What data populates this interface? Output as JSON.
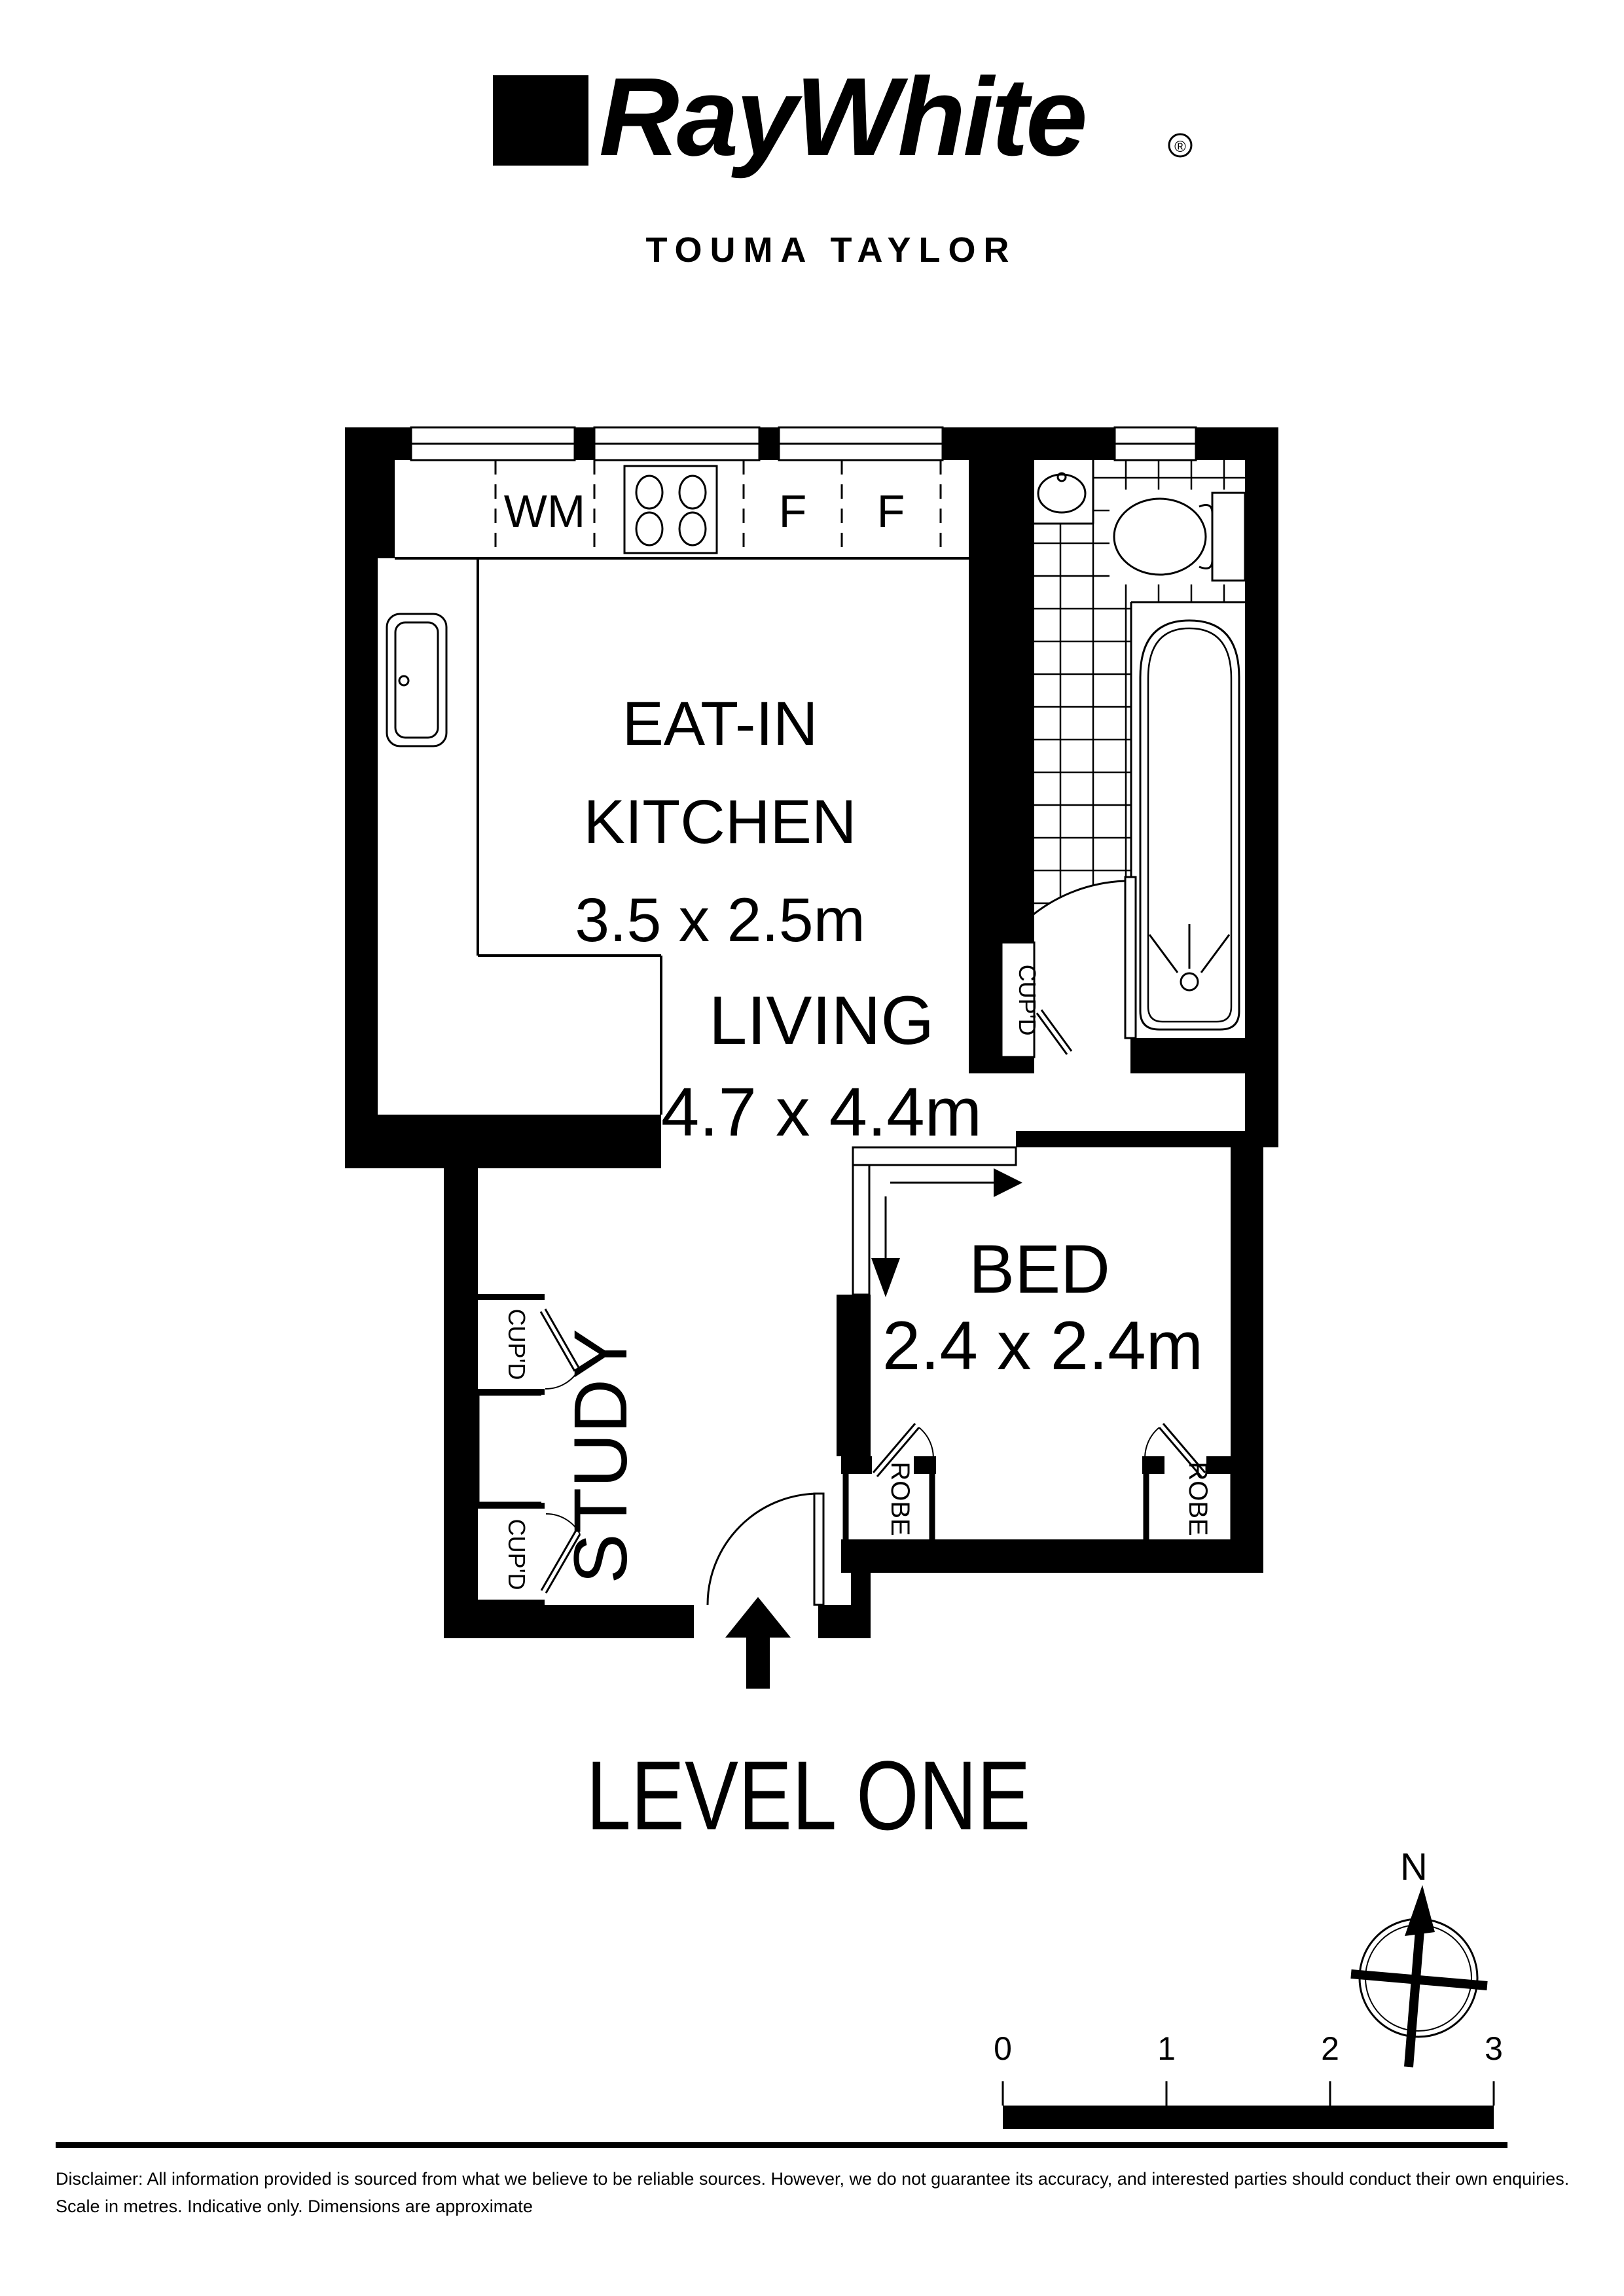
{
  "brand": {
    "logo_text": "RayWhite",
    "registered_mark": "®",
    "office_name": "TOUMA TAYLOR"
  },
  "plan": {
    "level_label": "LEVEL ONE",
    "rooms": {
      "kitchen": {
        "name_line1": "EAT-IN",
        "name_line2": "KITCHEN",
        "dimensions": "3.5 x 2.5m"
      },
      "living": {
        "name": "LIVING",
        "dimensions": "4.7 x 4.4m"
      },
      "bed": {
        "name": "BED",
        "dimensions": "2.4 x 2.4m"
      },
      "study": {
        "name": "STUDY"
      }
    },
    "labels": {
      "washing_machine": "WM",
      "fridge1": "F",
      "fridge2": "F",
      "cupboard_bath": "CUP'D",
      "cupboard_upper": "CUP'D",
      "cupboard_lower": "CUP'D",
      "robe_left": "ROBE",
      "robe_right": "ROBE"
    }
  },
  "compass": {
    "north_label": "N"
  },
  "scale_bar": {
    "ticks": [
      "0",
      "1",
      "2",
      "3"
    ]
  },
  "disclaimer": {
    "line1": "Disclaimer: All information provided is sourced from what we believe to be reliable sources. However, we do not guarantee  its accuracy, and interested parties should conduct their own enquiries.",
    "line2": "Scale in metres. Indicative only. Dimensions are approximate"
  },
  "colors": {
    "ink": "#000000",
    "paper": "#ffffff"
  }
}
